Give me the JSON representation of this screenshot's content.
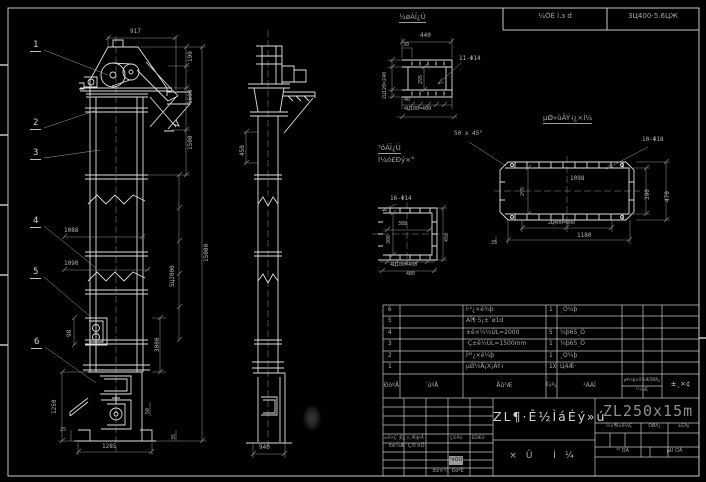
{
  "colors": {
    "background": "#000000",
    "line": "#d9d9d9",
    "dim_text": "#b2b2b2"
  },
  "frame": {
    "header_cell1": "¼ÓÈ Ì.з d",
    "header_cell2": "3Ц400-5.6ЦЖ"
  },
  "balloons": [
    "1",
    "2",
    "3",
    "4",
    "5",
    "6"
  ],
  "front": {
    "dim_917": "917",
    "dim_190": "190",
    "dim_1590": "1590",
    "dim_1500": "1500",
    "dim_15000": "15000",
    "dim_5x2000": "5Ц2000",
    "dim_3000": "3000",
    "dim_1088": "1088",
    "dim_1090": "1090",
    "dim_98": "98",
    "dim_1285": "1285",
    "dim_1250": "1250",
    "dim_25": "25",
    "dim_50": "50",
    "dim_35": "35"
  },
  "side": {
    "dim_450": "450",
    "dim_940": "940"
  },
  "inlet": {
    "label": "½øÁÏ¿Ú",
    "dim_440": "440",
    "dim_30": "30",
    "holes": "11-Φ14",
    "dim_4x100": "4Ц100=400",
    "dim_2x120": "2Ц120=240",
    "dim_40": "40",
    "dim_295": "295"
  },
  "outlet": {
    "label1": "³öÁÏ¿Ú",
    "label2": "Í¼ó£Ðý×°"
  },
  "foundation": {
    "label": "µØ»ùÂÝ˨¿×Í¼",
    "chamfer": "50 x 45°",
    "holes": "10-Φ18",
    "dim_1098": "1098",
    "dim_295": "295",
    "dim_390": "390",
    "dim_470": "470",
    "dim_2x400": "2Ц400=800",
    "dim_1180": "1180",
    "dim_35": "35"
  },
  "square": {
    "holes": "16-Φ14",
    "dim_388": "388",
    "dim_300": "300",
    "dim_4x100": "4Ц100=400",
    "dim_480": "480",
    "dim_450": "450"
  },
  "parts": {
    "rows": [
      {
        "num": "6",
        "code": "",
        "name": "Í·²¿×é¼þ",
        "qty": "1",
        "mat": "¸Ö¼þ"
      },
      {
        "num": "5",
        "code": "",
        "name": "ÁÏ¶·5¡±´ø1d",
        "qty": "",
        "mat": ""
      },
      {
        "num": "4",
        "code": "",
        "name": "±ê×¼½ÚL=2000",
        "qty": "5",
        "mat": "¼þ65¸Ö"
      },
      {
        "num": "3",
        "code": "",
        "name": "·Ç±ê½ÚL=1500mm",
        "qty": "1",
        "mat": "¼þ65¸Ö"
      },
      {
        "num": "2",
        "code": "",
        "name": "Î²²¿×é¼þ",
        "qty": "1",
        "mat": "¸Ö¼þ"
      },
      {
        "num": "1",
        "code": "",
        "name": "µØ½Å¡Х¡ÂÝ˨",
        "qty": "1X",
        "mat": "Ц4Æ·"
      }
    ],
    "header": {
      "num": "ÐòºÅ",
      "code": "´úºÅ",
      "name": "Ãû³Æ",
      "qty": "ÊýÁ¿",
      "mat": "²ÄÁÏ",
      "weight_top": "µ¥¼þ×Ü¼ÆÖØÁ¿",
      "weight_bottom": "¹²¼Æ",
      "note": "±¸×¢"
    }
  },
  "titleblock": {
    "rev_cell1": "±ê¼Ç´¦Êý",
    "rev_cell2": "¸ü¸ÄÎļþºÅ",
    "rev_cell3": "Ç©Ãû",
    "rev_cell4": "ÈÕÆÚ",
    "sig1": "Éè¼Æ",
    "sig2": "Ç©×Ö",
    "chip": "¹¤ÒÕ",
    "sig3": "±ê×¼",
    "sig4": "ÉóºË",
    "title": "ZL¶·Ê½ÌáÉý»ú",
    "subtitle": "×Ü Í¼",
    "drawing_no": "ZL250x15m",
    "stage": "½×¶Î±ê¼Ç",
    "weight": "ÖØÁ¿",
    "scale": "±ÈÀý",
    "sheets_total": "¹² ÕÅ",
    "sheets_no": "µÚ ÕÅ"
  }
}
